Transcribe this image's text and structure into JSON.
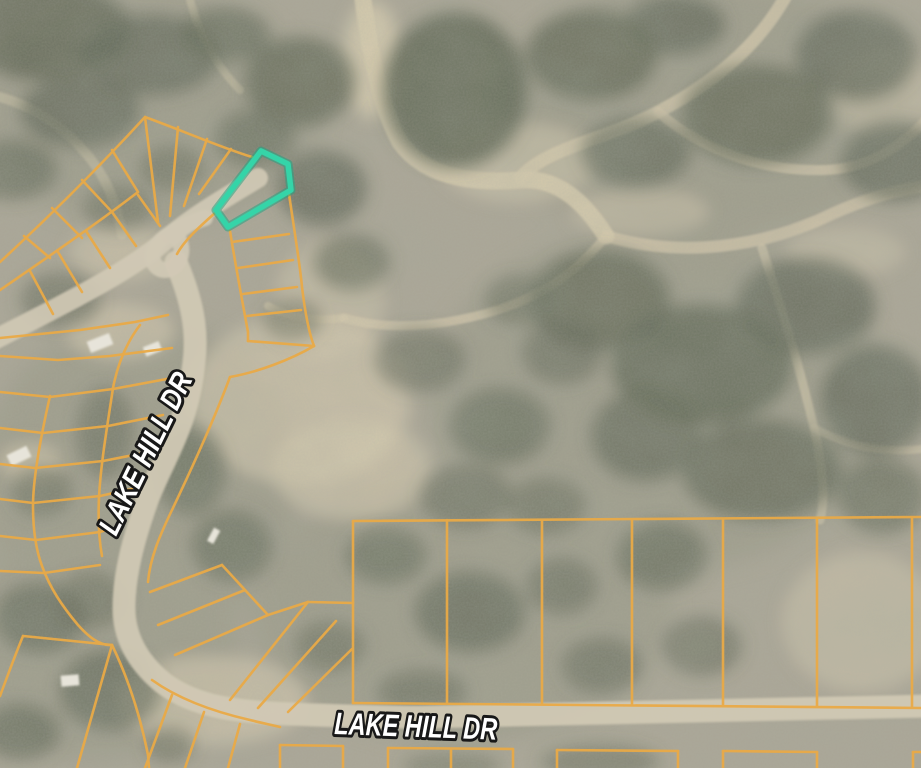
{
  "map": {
    "type": "satellite-parcel-map",
    "street_labels": [
      {
        "id": "lake-hill-dr-along-road",
        "text": "LAKE HILL DR",
        "orientation": "rotated-along-road"
      },
      {
        "id": "lake-hill-dr-bottom",
        "text": "LAKE HILL DR",
        "orientation": "horizontal"
      }
    ],
    "highlighted_parcel": {
      "description": "flag-shaped lot outlined in teal near top center-left",
      "outline_color": "#2BD2A4"
    },
    "colors": {
      "parcel_line": "#E8A53D",
      "road_surface": "#CFC7B1",
      "terrain_base": "#A7A291",
      "brush_dark": "#565D4B",
      "sand_light": "#DACDAF",
      "label_fill": "#FFFFFF",
      "label_outline": "#0C0C0C"
    }
  }
}
